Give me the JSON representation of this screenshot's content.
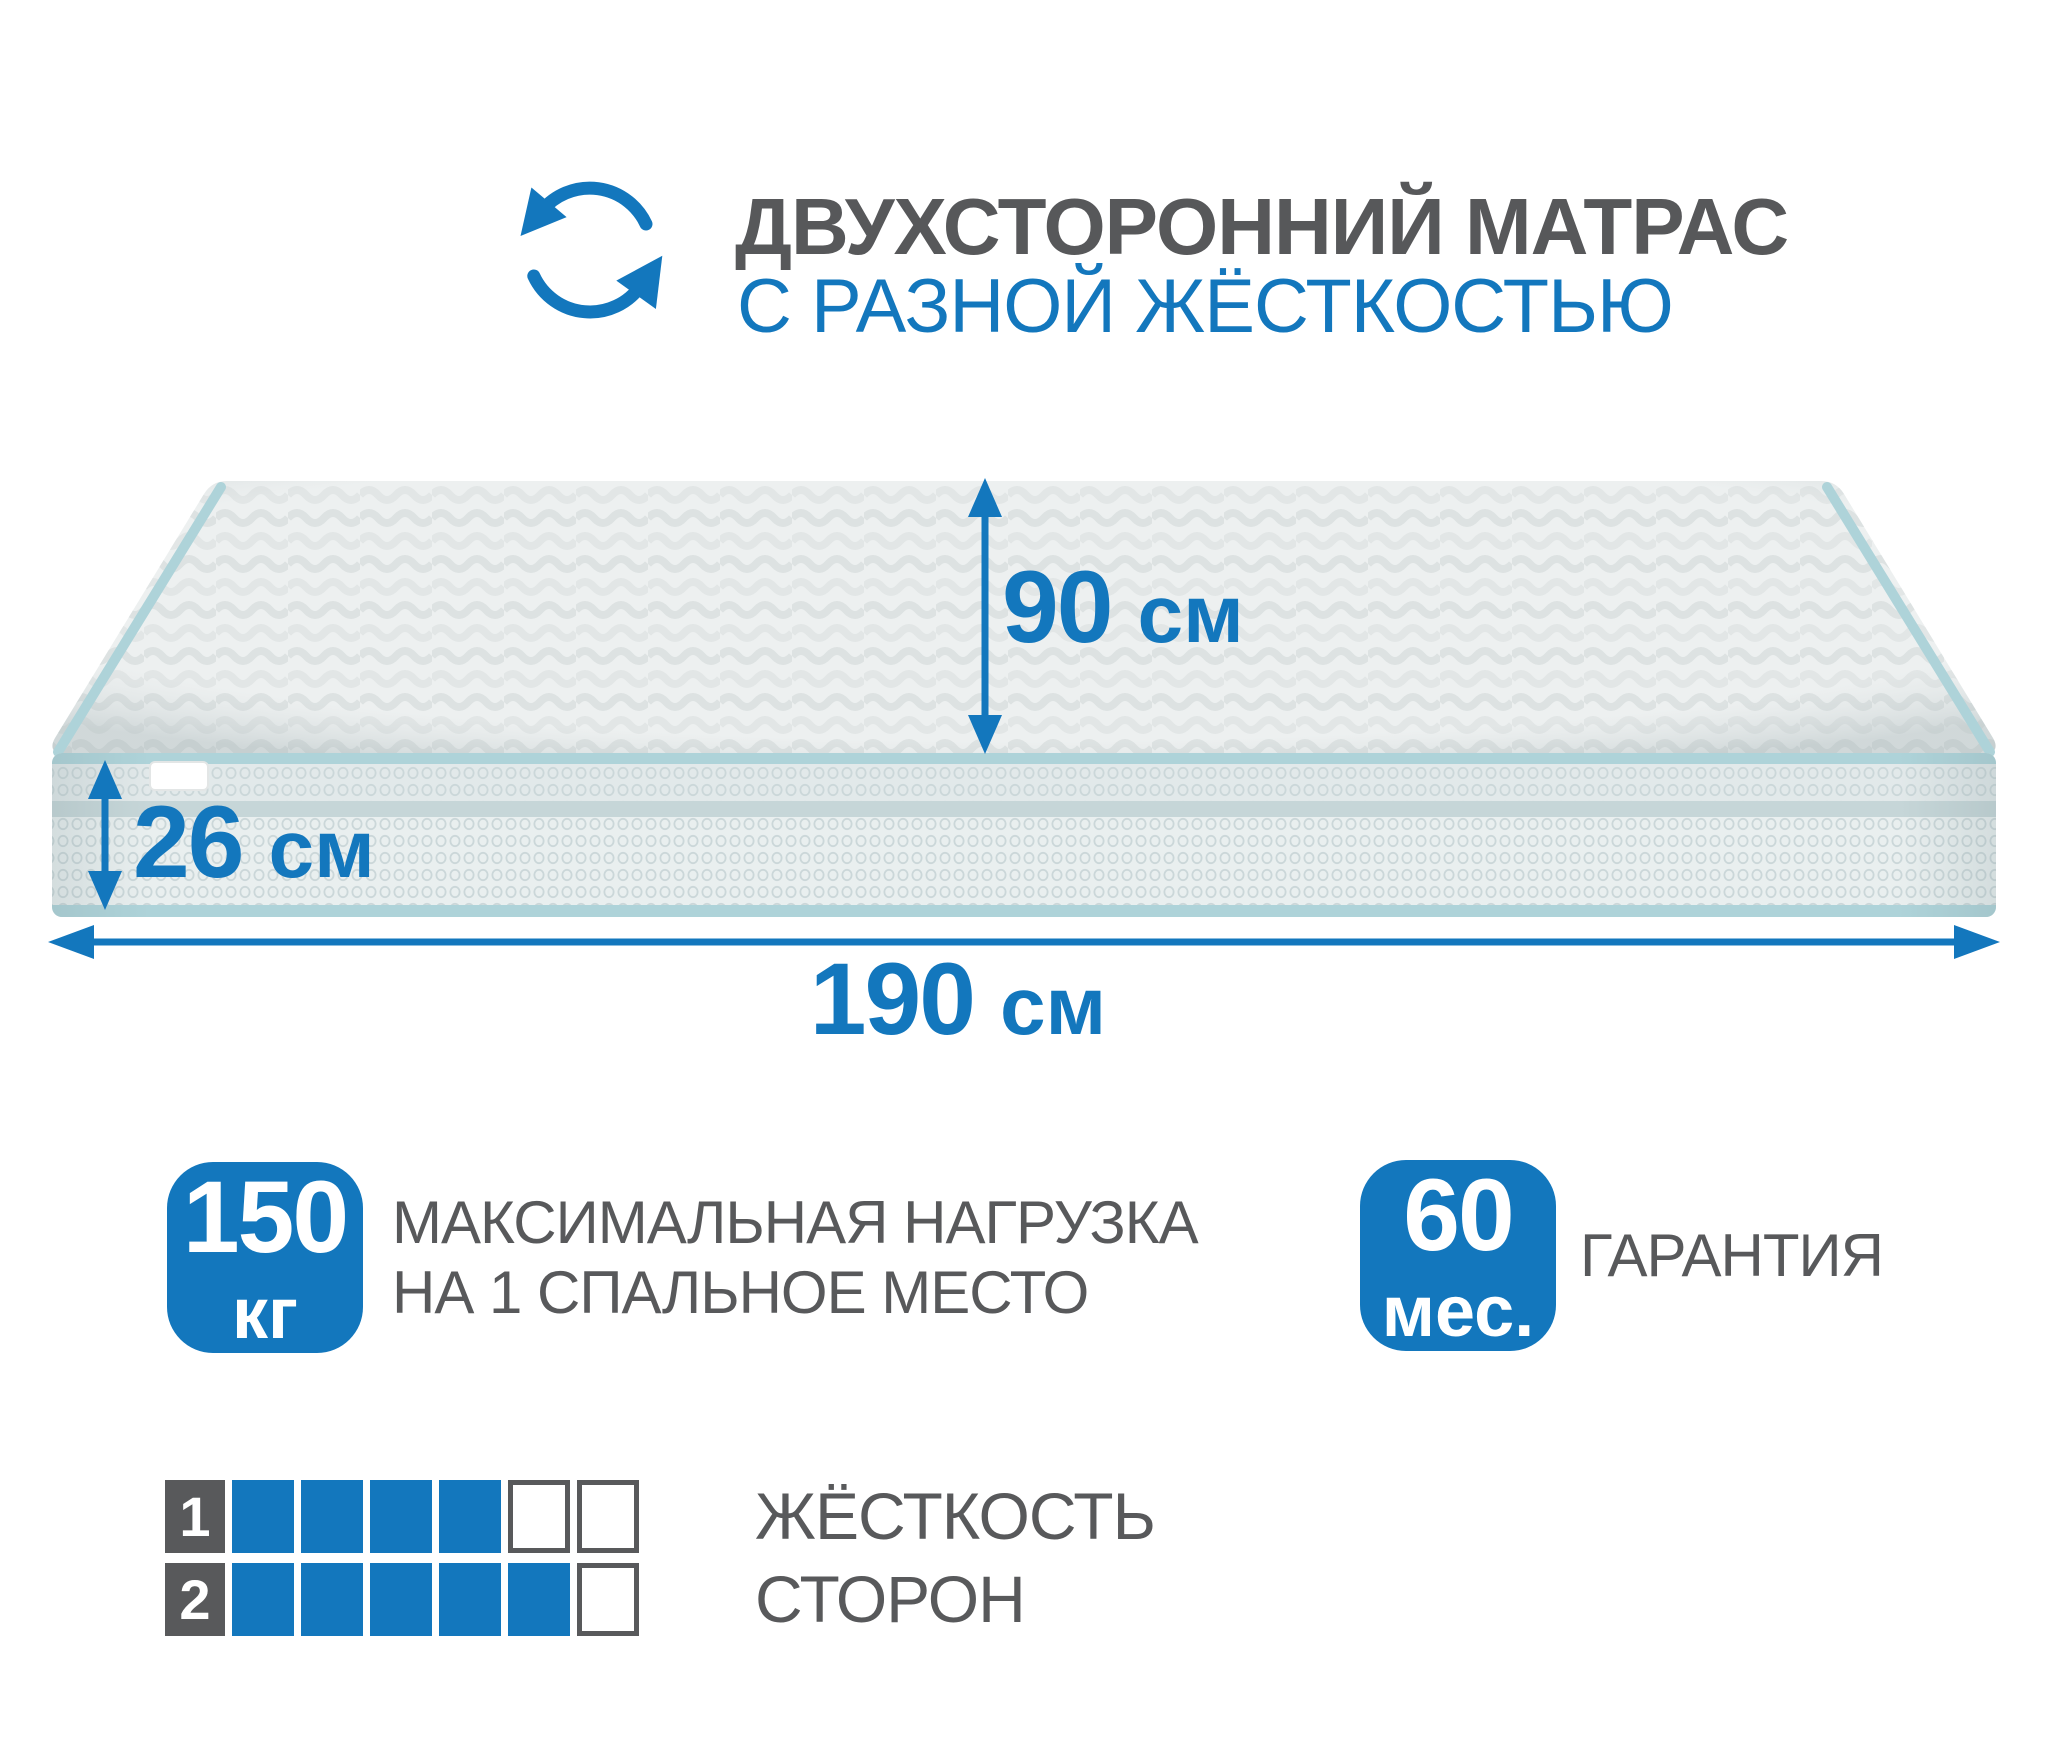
{
  "colors": {
    "accent_blue": "#1377bd",
    "text_gray": "#58595b",
    "piping_blue": "#aed3d9",
    "side_band": "#c6d6d8",
    "fabric_light": "#e9efef",
    "top_surface": "#edf0f0"
  },
  "header": {
    "title": "ДВУХСТОРОННИЙ МАТРАС",
    "subtitle": "С РАЗНОЙ ЖЁСТКОСТЬЮ",
    "icon": "rotate-arrows"
  },
  "dimensions": {
    "depth": {
      "value": "90",
      "unit": "см"
    },
    "height": {
      "value": "26",
      "unit": "см"
    },
    "width": {
      "value": "190",
      "unit": "см"
    }
  },
  "badges": {
    "max_load": {
      "value": "150",
      "unit": "кг",
      "label_line1": "МАКСИМАЛЬНАЯ НАГРУЗКА",
      "label_line2": "НА 1 СПАЛЬНОЕ МЕСТО"
    },
    "warranty": {
      "value": "60",
      "unit": "мес.",
      "label": "ГАРАНТИЯ"
    }
  },
  "firmness": {
    "label_line1": "ЖЁСТКОСТЬ",
    "label_line2": "СТОРОН",
    "scale_max": 6,
    "sides": [
      {
        "number": "1",
        "filled": 4
      },
      {
        "number": "2",
        "filled": 5
      }
    ]
  }
}
